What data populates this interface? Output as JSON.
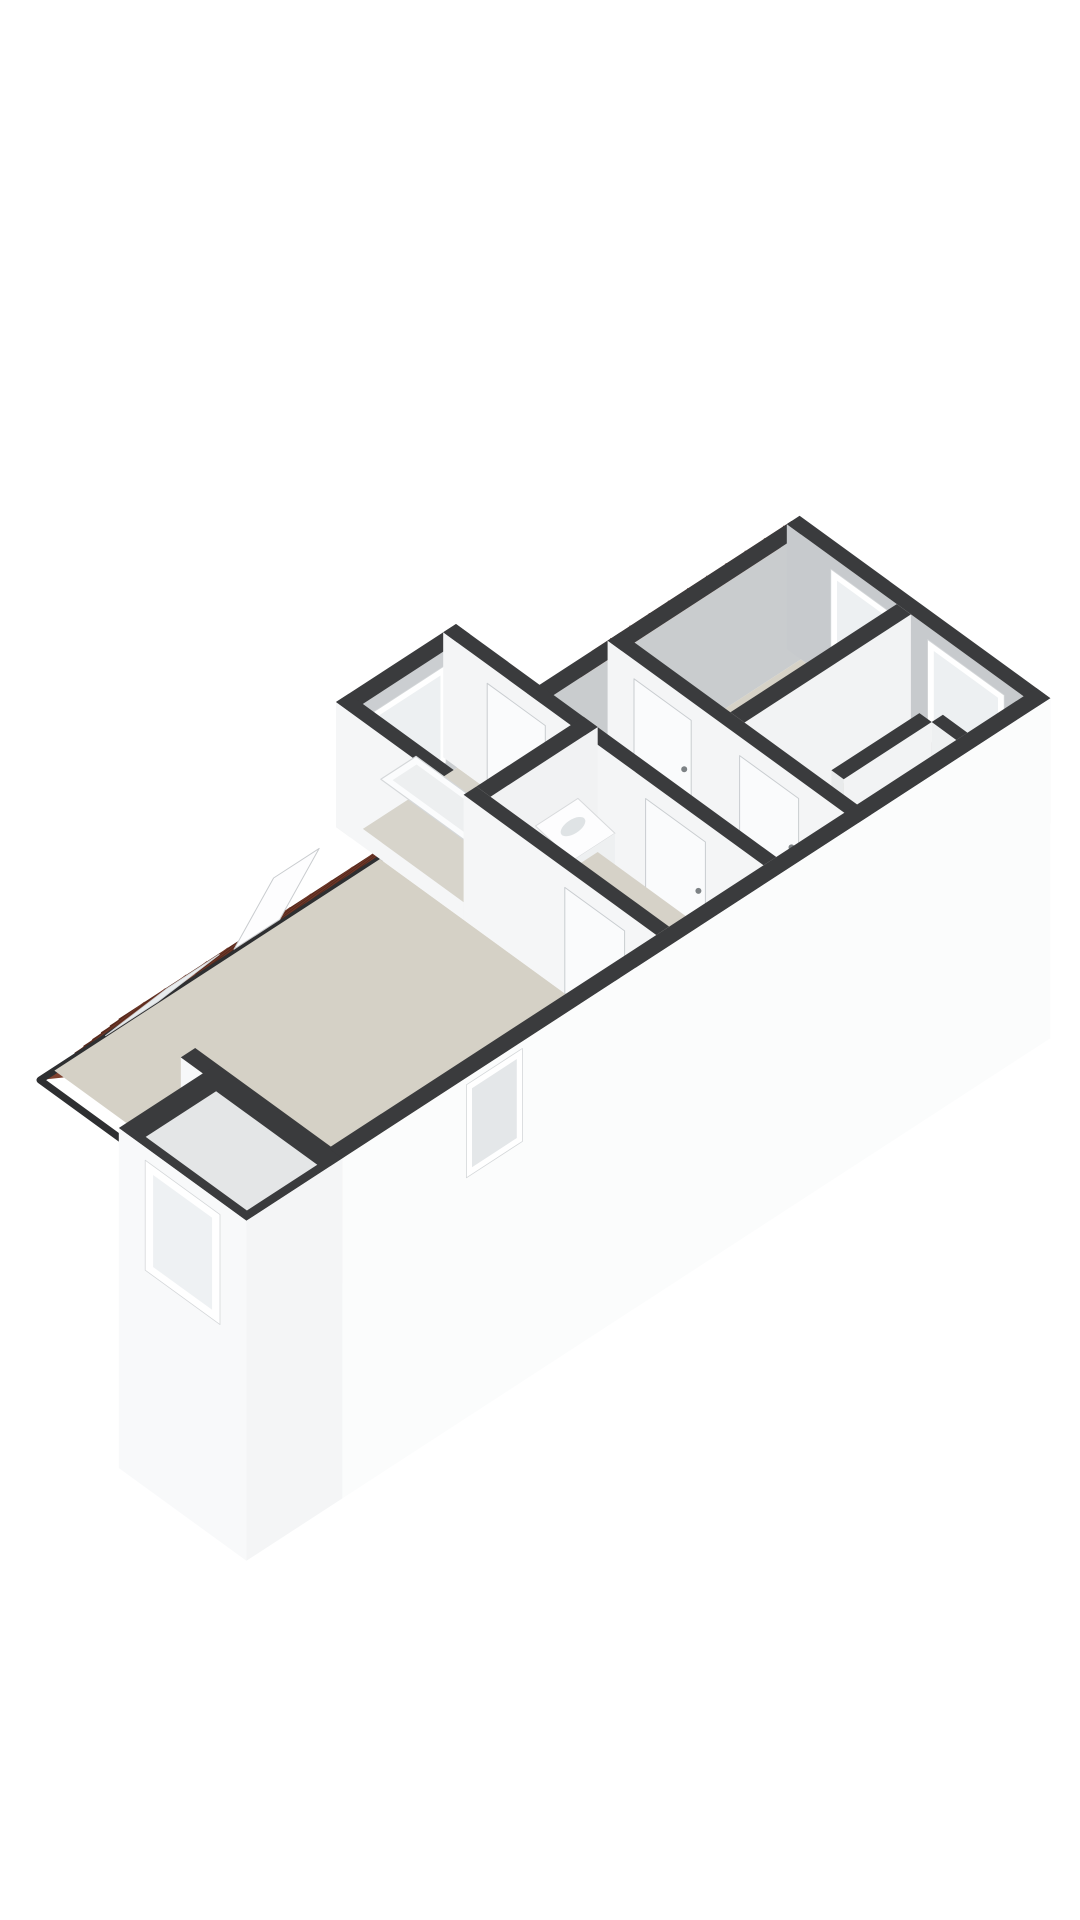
{
  "scene": {
    "background": "#ffffff",
    "canvas": {
      "width": 1080,
      "height": 1920
    },
    "projection": {
      "ox": 40,
      "oy": 1080,
      "ax": 0.8,
      "ay": -0.52,
      "bx": 0.88,
      "by": 0.64,
      "wallHeight": 125
    },
    "palette": {
      "wall_cap": "#3a3b3d",
      "wall_white": "#f5f6f7",
      "wall_bright": "#fbfcfc",
      "wall_gray": "#c9ccce",
      "wall_midgray": "#e6e8e9",
      "floor_beige": "#d6d2c7",
      "floor_beige_dark": "#d2cec4",
      "roof_tile": "#8d4a35",
      "roof_line_dark": "#572a1d",
      "roof_line_mid": "#70392a",
      "glass": "#edf0f2",
      "frame_white": "#ffffff",
      "fixture_white": "#fbfcfd",
      "eave_dark": "#2e2f31"
    },
    "elements": [
      {
        "n": "upper-roof-tiles",
        "t": "roofU",
        "u1": 640,
        "u2": 890,
        "v1": 0,
        "v2": 45,
        "z1": 0,
        "z2": 125,
        "f": "#8d4a35",
        "rs": 10,
        "cs": 24,
        "rc": "#572a1d",
        "cc": "#70392a"
      },
      {
        "n": "upper-roof-eave-edge",
        "t": "line3",
        "pts": [
          [
            640,
            0,
            0
          ],
          [
            890,
            0,
            0
          ]
        ],
        "s": "#2e2f31",
        "sw": 6
      },
      {
        "n": "bedrooms-nw-wall",
        "t": "wallU",
        "u1": 559,
        "u2": 890,
        "v": 45,
        "th": 16,
        "h": 125,
        "f": "#c9ccce",
        "e": "#e6e8e9",
        "c": "#3a3b3d"
      },
      {
        "n": "left-bedroom-floor",
        "t": "poly",
        "pts": [
          [
            676,
            61,
            0
          ],
          [
            884,
            61,
            0
          ],
          [
            884,
            170,
            0
          ],
          [
            676,
            170,
            0
          ]
        ],
        "f": "#d6d2c7"
      },
      {
        "n": "right-bedroom-floor",
        "t": "poly",
        "pts": [
          [
            676,
            186,
            0
          ],
          [
            884,
            186,
            0
          ],
          [
            884,
            314,
            0
          ],
          [
            676,
            314,
            0
          ]
        ],
        "f": "#d8d4c9"
      },
      {
        "n": "gable-end-wall",
        "t": "wallV",
        "u": 884,
        "v1": 45,
        "v2": 330,
        "th": 16,
        "h": 125,
        "f": "#c7cacd",
        "e": "#f2f3f4",
        "c": "#3a3b3d"
      },
      {
        "n": "left-bedroom-window",
        "t": "win",
        "plane": "u",
        "at": 884,
        "a1": 95,
        "a2": 170,
        "z1": 22,
        "z2": 112,
        "fw": 7,
        "ff": "#ffffff",
        "gf": "#edf0f2"
      },
      {
        "n": "right-bedroom-window",
        "t": "win",
        "plane": "u",
        "at": 884,
        "a1": 205,
        "a2": 292,
        "z1": 12,
        "z2": 112,
        "fw": 7,
        "ff": "#ffffff",
        "gf": "#edf0f2"
      },
      {
        "n": "bedroom-divider-wall",
        "t": "wallU",
        "u1": 676,
        "u2": 884,
        "v": 170,
        "th": 16,
        "h": 125,
        "f": "#f2f3f4",
        "e": "#e8eaeb",
        "c": "#3a3b3d"
      },
      {
        "n": "closet-knee-wall",
        "t": "wallU",
        "u1": 690,
        "u2": 800,
        "v": 272,
        "th": 14,
        "h": 125,
        "f": "#f2f3f4",
        "e": "#e8eaeb",
        "c": "#3a3b3d"
      },
      {
        "n": "closet-return-wall",
        "t": "wallV",
        "u": 800,
        "v1": 286,
        "v2": 314,
        "th": 14,
        "h": 125,
        "f": "#eef0f1",
        "e": "#e8eaeb",
        "c": "#3a3b3d"
      },
      {
        "n": "corridor-floor",
        "t": "poly",
        "pts": [
          [
            575,
            61,
            0
          ],
          [
            660,
            61,
            0
          ],
          [
            660,
            314,
            0
          ],
          [
            575,
            314,
            0
          ]
        ],
        "f": "#d3cfc5"
      },
      {
        "n": "corridor-bedrooms-wall",
        "t": "wallV",
        "u": 660,
        "v1": 45,
        "v2": 330,
        "th": 16,
        "h": 125,
        "f": "#f4f5f6",
        "e": "#e8eaeb",
        "c": "#3a3b3d"
      },
      {
        "n": "left-bedroom-door",
        "t": "door",
        "plane": "u",
        "at": 660,
        "a1": 75,
        "a2": 140,
        "z1": 0,
        "z2": 106,
        "f": "#fafbfc",
        "s": "#c9cdd0",
        "handle": [
          132,
          52
        ]
      },
      {
        "n": "right-bedroom-door",
        "t": "door",
        "plane": "u",
        "at": 660,
        "a1": 195,
        "a2": 262,
        "z1": 0,
        "z2": 106,
        "f": "#fafbfc",
        "s": "#c9cdd0",
        "handle": [
          254,
          52
        ]
      },
      {
        "n": "main-roof-tiles",
        "t": "roofU",
        "u1": 0,
        "u2": 430,
        "v1": 0,
        "v2": 95,
        "z1": 0,
        "z2": 125,
        "f": "#8d4a35",
        "rs": 10,
        "cs": 26,
        "rc": "#572a1d",
        "cc": "#70392a"
      },
      {
        "n": "roof-hip-facet",
        "t": "poly",
        "pts": [
          [
            0,
            0,
            0
          ],
          [
            90,
            95,
            125
          ],
          [
            0,
            170,
            125
          ]
        ],
        "f": "#7f4230"
      },
      {
        "n": "main-roof-eave-edge",
        "t": "line3",
        "pts": [
          [
            430,
            0,
            0
          ],
          [
            0,
            0,
            0
          ],
          [
            0,
            170,
            0
          ]
        ],
        "s": "#2e2f31",
        "sw": 7
      },
      {
        "n": "skylight-closed-frame",
        "t": "poly",
        "pts": [
          [
            60,
            20,
            26
          ],
          [
            125,
            20,
            26
          ],
          [
            125,
            90,
            118
          ],
          [
            60,
            90,
            118
          ]
        ],
        "f": "#ffffff",
        "s": "#d4d7d9",
        "sw": 1
      },
      {
        "n": "skylight-closed-glass",
        "t": "poly",
        "pts": [
          [
            68,
            27,
            35
          ],
          [
            117,
            27,
            35
          ],
          [
            117,
            83,
            109
          ],
          [
            68,
            83,
            109
          ]
        ],
        "f": "#e8ecee"
      },
      {
        "n": "skylight-open-sash",
        "t": "poly",
        "pts": [
          [
            215,
            25,
            35
          ],
          [
            272,
            25,
            35
          ],
          [
            272,
            70,
            135
          ],
          [
            215,
            70,
            135
          ]
        ],
        "f": "#fdfdfe",
        "s": "#c9cccf",
        "sw": 1
      },
      {
        "n": "big-room-floor",
        "t": "poly",
        "pts": [
          [
            18,
            0,
            0
          ],
          [
            425,
            0,
            0
          ],
          [
            425,
            314,
            0
          ],
          [
            18,
            314,
            0
          ]
        ],
        "f": "#d5d1c6"
      },
      {
        "n": "sw-end-wall",
        "t": "wallV",
        "u": 0,
        "v1": 160,
        "v2": 330,
        "th": 18,
        "h": 125,
        "f": "#f7f8f9",
        "e": "#f0f1f2",
        "c": "#3a3b3d"
      },
      {
        "n": "bay-nw-wall",
        "t": "wallU",
        "u1": 425,
        "u2": 575,
        "v": -50,
        "th": 16,
        "h": 125,
        "f": "#cbced1",
        "e": "#e6e8e9",
        "c": "#3a3b3d"
      },
      {
        "n": "bay-window",
        "t": "win",
        "plane": "v",
        "at": -34,
        "a1": 455,
        "a2": 545,
        "z1": 12,
        "z2": 110,
        "fw": 7,
        "ff": "#ffffff",
        "gf": "#edf0f2"
      },
      {
        "n": "bay-sw-wall",
        "t": "wallV",
        "u": 425,
        "v1": -50,
        "v2": 95,
        "th": 16,
        "h": 125,
        "f": "#f5f6f7",
        "e": "#eceeef",
        "c": "#3a3b3d"
      },
      {
        "n": "bath-room-floor",
        "t": "poly",
        "pts": [
          [
            441,
            -34,
            0
          ],
          [
            559,
            -34,
            0
          ],
          [
            559,
            95,
            0
          ],
          [
            441,
            95,
            0
          ]
        ],
        "f": "#d7d4cb"
      },
      {
        "n": "bathtub-rim",
        "t": "poly",
        "pts": [
          [
            448,
            -20,
            55
          ],
          [
            492,
            -20,
            55
          ],
          [
            492,
            80,
            55
          ],
          [
            448,
            80,
            55
          ]
        ],
        "f": "#fbfcfd",
        "s": "#d5d8da",
        "sw": 1.2
      },
      {
        "n": "bathtub-basin",
        "t": "poly",
        "pts": [
          [
            455,
            -13,
            55
          ],
          [
            485,
            -13,
            55
          ],
          [
            485,
            72,
            55
          ],
          [
            455,
            72,
            55
          ]
        ],
        "f": "#edeff0"
      },
      {
        "n": "bathtub-front-panel",
        "t": "poly",
        "pts": [
          [
            448,
            80,
            55
          ],
          [
            492,
            80,
            55
          ],
          [
            492,
            80,
            8
          ],
          [
            448,
            80,
            8
          ]
        ],
        "f": "#f3f4f5"
      },
      {
        "n": "corridor-west-wall",
        "t": "wallV",
        "u": 559,
        "v1": -50,
        "v2": 314,
        "th": 16,
        "h": 125,
        "f": "#f4f5f6",
        "e": "#e9ebec",
        "c": "#3a3b3d"
      },
      {
        "n": "bath-room-door",
        "t": "door",
        "plane": "u",
        "at": 559,
        "a1": 0,
        "a2": 66,
        "z1": 0,
        "z2": 106,
        "f": "#fafbfc",
        "s": "#c9cdd0",
        "handle": [
          58,
          52
        ]
      },
      {
        "n": "shower-room-door",
        "t": "door",
        "plane": "u",
        "at": 559,
        "a1": 180,
        "a2": 248,
        "z1": 0,
        "z2": 106,
        "f": "#fafbfc",
        "s": "#c9cdd0",
        "handle": [
          240,
          52
        ]
      },
      {
        "n": "sink-wall",
        "t": "wallU",
        "u1": 441,
        "u2": 575,
        "v": 95,
        "th": 16,
        "h": 125,
        "f": "#f1f2f3",
        "e": "#e8eaeb",
        "c": "#3a3b3d"
      },
      {
        "n": "sink-top",
        "t": "poly",
        "pts": [
          [
            505,
            104,
            58
          ],
          [
            558,
            104,
            58
          ],
          [
            558,
            146,
            50
          ],
          [
            505,
            146,
            50
          ]
        ],
        "f": "#fdfdfe",
        "s": "#d8dadc",
        "sw": 1
      },
      {
        "n": "sink-front",
        "t": "poly",
        "pts": [
          [
            505,
            146,
            50
          ],
          [
            558,
            146,
            50
          ],
          [
            558,
            146,
            16
          ],
          [
            505,
            146,
            16
          ]
        ],
        "f": "#eef0f1"
      },
      {
        "n": "sink-bowl",
        "t": "ellipse",
        "c": [
          531,
          123,
          56
        ],
        "rx": 14,
        "ry": 7,
        "rot": -33,
        "f": "#dfe3e5"
      },
      {
        "n": "shower-room-floor",
        "t": "poly",
        "pts": [
          [
            441,
            111,
            0
          ],
          [
            575,
            111,
            0
          ],
          [
            575,
            314,
            0
          ],
          [
            441,
            314,
            0
          ]
        ],
        "f": "#d6d2c8"
      },
      {
        "n": "big-room-ne-wall",
        "t": "wallV",
        "u": 425,
        "v1": 95,
        "v2": 314,
        "th": 16,
        "h": 125,
        "f": "#f5f6f7",
        "e": "#eaeced",
        "c": "#3a3b3d"
      },
      {
        "n": "big-room-door",
        "t": "door",
        "plane": "u",
        "at": 425,
        "a1": 210,
        "a2": 278,
        "z1": 0,
        "z2": 106,
        "f": "#fafbfc",
        "s": "#c9cdd0",
        "handle": [
          270,
          52
        ]
      },
      {
        "n": "facade-cap",
        "t": "poly",
        "pts": [
          [
            15,
            314,
            125
          ],
          [
            900,
            314,
            125
          ],
          [
            900,
            330,
            125
          ],
          [
            15,
            330,
            125
          ]
        ],
        "f": "#3a3b3d"
      },
      {
        "n": "facade-face",
        "t": "poly",
        "pts": [
          [
            15,
            330,
            125
          ],
          [
            900,
            330,
            125
          ],
          [
            900,
            330,
            -215
          ],
          [
            15,
            330,
            -215
          ]
        ],
        "f": "#fbfcfc"
      },
      {
        "n": "facade-window",
        "t": "win",
        "plane": "v",
        "at": 330,
        "a1": 170,
        "a2": 240,
        "z1": 25,
        "z2": 118,
        "fw": 7,
        "ff": "#ffffff",
        "gf": "#e4e7e9"
      },
      {
        "n": "dormer-cap",
        "t": "poly",
        "pts": [
          [
            -105,
            185,
            125
          ],
          [
            15,
            185,
            125
          ],
          [
            15,
            330,
            125
          ],
          [
            -105,
            330,
            125
          ]
        ],
        "f": "#3a3b3d"
      },
      {
        "n": "dormer-inner",
        "t": "poly",
        "pts": [
          [
            -89,
            201,
            118
          ],
          [
            -1,
            201,
            118
          ],
          [
            -1,
            316,
            118
          ],
          [
            -89,
            316,
            118
          ]
        ],
        "f": "#e4e6e7"
      },
      {
        "n": "dormer-sw-face",
        "t": "poly",
        "pts": [
          [
            -105,
            185,
            125
          ],
          [
            -105,
            330,
            125
          ],
          [
            -105,
            330,
            -215
          ],
          [
            -105,
            185,
            -215
          ]
        ],
        "f": "#f8f9fa"
      },
      {
        "n": "dormer-window",
        "t": "win",
        "plane": "u",
        "at": -105,
        "a1": 215,
        "a2": 300,
        "z1": 2,
        "z2": 112,
        "fw": 9,
        "ff": "#ffffff",
        "gf": "#eef1f3"
      },
      {
        "n": "dormer-se-face",
        "t": "poly",
        "pts": [
          [
            -105,
            330,
            125
          ],
          [
            15,
            330,
            125
          ],
          [
            15,
            330,
            -215
          ],
          [
            -105,
            330,
            -215
          ]
        ],
        "f": "#f4f5f6"
      }
    ]
  }
}
